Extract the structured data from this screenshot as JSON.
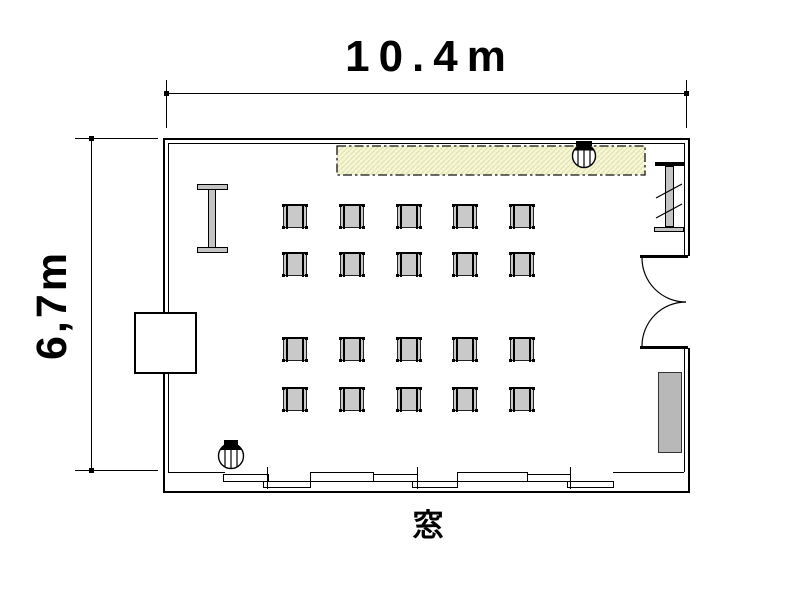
{
  "dimensions": {
    "width_label": "10.4m",
    "height_label": "6,7m"
  },
  "labels": {
    "window": "窓"
  },
  "room": {
    "desk_grid": {
      "rows": 4,
      "cols": 5,
      "count": 20,
      "col_x": [
        283,
        340,
        397,
        453,
        510
      ],
      "row_y": [
        204,
        252,
        337,
        387
      ],
      "size": 24
    }
  },
  "colors": {
    "line": "#000000",
    "desk_fill": "#c9c9c9",
    "furniture_gray": "#c4c4c4",
    "shelf_gray": "#b8b8b8",
    "hatch_fill": "#f6f6d9",
    "hatch_line": "#e2e2a8"
  }
}
